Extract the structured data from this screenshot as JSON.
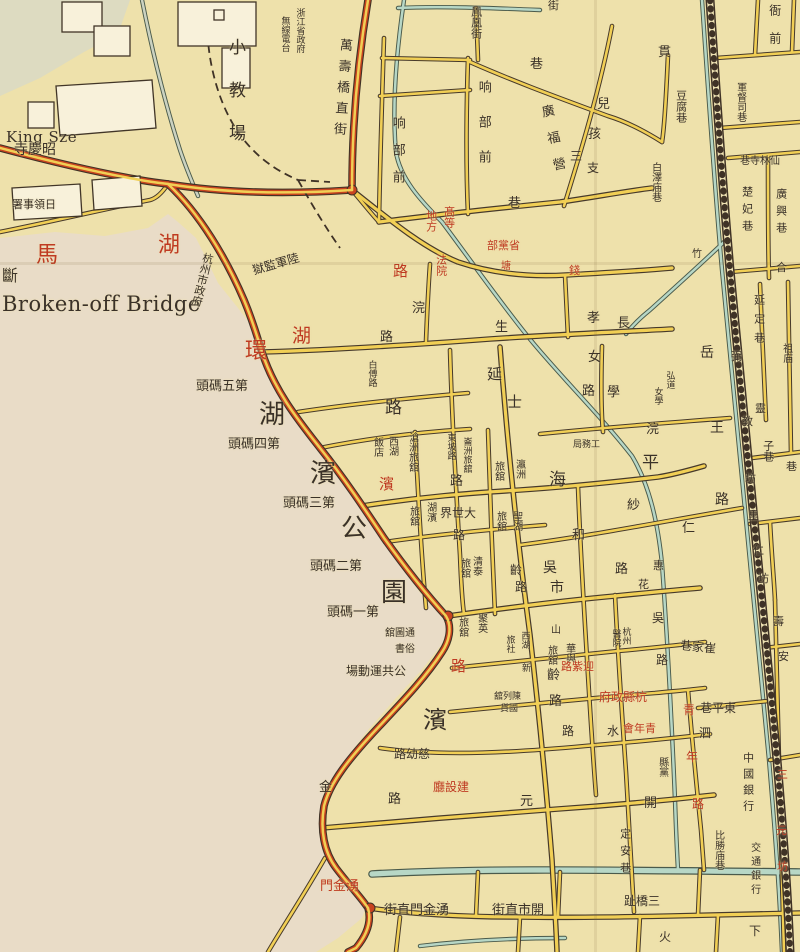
{
  "page_title": "Broken-off Bridge",
  "map": {
    "colors": {
      "paper": "#eee1ab",
      "lake": "#e9dcc7",
      "road": "#f1cf55",
      "road_red": "#c8431f",
      "stream": "#b7d7c6",
      "ink": "#3a3128",
      "red_text": "#bf3a22"
    },
    "dots": [
      {
        "x": 352,
        "y": 190
      },
      {
        "x": 448,
        "y": 616
      },
      {
        "x": 370,
        "y": 908
      }
    ],
    "labels": [
      {
        "t": "King Sze",
        "x": 6,
        "y": 130,
        "s": 15,
        "d": "h",
        "c": "ink",
        "en": 1
      },
      {
        "t": "寺慶昭",
        "x": 14,
        "y": 143,
        "s": 14,
        "d": "h"
      },
      {
        "t": "署事領日",
        "x": 12,
        "y": 199,
        "s": 11,
        "d": "h"
      },
      {
        "t": "斷",
        "x": 2,
        "y": 268,
        "s": 16,
        "d": "h"
      },
      {
        "t": "Broken-off Bridge",
        "x": 2,
        "y": 293,
        "s": 21,
        "d": "h",
        "c": "ink",
        "en": 1
      },
      {
        "t": "馬",
        "x": 36,
        "y": 244,
        "s": 22,
        "d": "h",
        "c": "red"
      },
      {
        "t": "湖",
        "x": 158,
        "y": 234,
        "s": 22,
        "d": "h",
        "c": "red"
      },
      {
        "t": "杭州市政府",
        "x": 196,
        "y": 252,
        "s": 11,
        "d": "v",
        "r": 14
      },
      {
        "t": "環",
        "x": 245,
        "y": 340,
        "s": 22,
        "d": "h",
        "c": "red"
      },
      {
        "t": "湖",
        "x": 292,
        "y": 326,
        "s": 19,
        "d": "h",
        "c": "red"
      },
      {
        "t": "路",
        "x": 393,
        "y": 264,
        "s": 15,
        "d": "h",
        "c": "red"
      },
      {
        "t": "獄監軍陸",
        "x": 252,
        "y": 258,
        "s": 12,
        "d": "h",
        "r": -16
      },
      {
        "t": "小教場",
        "x": 226,
        "y": 38,
        "s": 17,
        "d": "v",
        "lh": 26
      },
      {
        "t": "浙江省政府",
        "x": 294,
        "y": 8,
        "s": 9,
        "d": "v"
      },
      {
        "t": "無線電台",
        "x": 279,
        "y": 16,
        "s": 9,
        "d": "v"
      },
      {
        "t": "萬壽橋直街",
        "x": 334,
        "y": 38,
        "s": 13,
        "d": "v",
        "r": 4,
        "lh": 8
      },
      {
        "t": "响部前",
        "x": 390,
        "y": 116,
        "s": 13,
        "d": "v",
        "lh": 14
      },
      {
        "t": "响部前",
        "x": 476,
        "y": 80,
        "s": 13,
        "d": "v",
        "lh": 22
      },
      {
        "t": "巷",
        "x": 508,
        "y": 197,
        "s": 13,
        "d": "h"
      },
      {
        "t": "鳳凰街",
        "x": 470,
        "y": 6,
        "s": 11,
        "d": "v"
      },
      {
        "t": "街",
        "x": 548,
        "y": 0,
        "s": 11,
        "d": "h"
      },
      {
        "t": "巷",
        "x": 530,
        "y": 58,
        "s": 13,
        "d": "h"
      },
      {
        "t": "廣福營",
        "x": 546,
        "y": 104,
        "s": 13,
        "d": "v",
        "r": -12,
        "lh": 14
      },
      {
        "t": "孩",
        "x": 588,
        "y": 128,
        "s": 13,
        "d": "h"
      },
      {
        "t": "兒",
        "x": 597,
        "y": 98,
        "s": 13,
        "d": "h"
      },
      {
        "t": "三",
        "x": 570,
        "y": 150,
        "s": 12,
        "d": "h"
      },
      {
        "t": "支",
        "x": 587,
        "y": 162,
        "s": 12,
        "d": "h"
      },
      {
        "t": "竹",
        "x": 692,
        "y": 250,
        "s": 10,
        "d": "h"
      },
      {
        "t": "貫",
        "x": 658,
        "y": 46,
        "s": 13,
        "d": "h"
      },
      {
        "t": "豆腐巷",
        "x": 675,
        "y": 90,
        "s": 11,
        "d": "v"
      },
      {
        "t": "軍督司巷",
        "x": 734,
        "y": 82,
        "s": 10,
        "d": "v"
      },
      {
        "t": "巷寺林仙",
        "x": 740,
        "y": 157,
        "s": 10,
        "d": "h"
      },
      {
        "t": "楚妃巷",
        "x": 741,
        "y": 186,
        "s": 11,
        "d": "v",
        "lh": 6
      },
      {
        "t": "廣興巷",
        "x": 775,
        "y": 188,
        "s": 11,
        "d": "v",
        "lh": 6
      },
      {
        "t": "合",
        "x": 776,
        "y": 262,
        "s": 11,
        "d": "h"
      },
      {
        "t": "白澤庙巷",
        "x": 649,
        "y": 162,
        "s": 10,
        "d": "v"
      },
      {
        "t": "衙前",
        "x": 768,
        "y": 4,
        "s": 12,
        "d": "v",
        "lh": 16
      },
      {
        "t": "地方",
        "x": 425,
        "y": 210,
        "s": 11,
        "d": "v",
        "c": "red"
      },
      {
        "t": "髙等",
        "x": 443,
        "y": 206,
        "s": 11,
        "d": "v",
        "c": "red"
      },
      {
        "t": "法院",
        "x": 435,
        "y": 254,
        "s": 11,
        "d": "v",
        "c": "red"
      },
      {
        "t": "部黨省",
        "x": 487,
        "y": 240,
        "s": 11,
        "d": "h",
        "c": "red"
      },
      {
        "t": "塘",
        "x": 501,
        "y": 262,
        "s": 10,
        "d": "h",
        "c": "red"
      },
      {
        "t": "錢",
        "x": 569,
        "y": 265,
        "s": 11,
        "d": "h",
        "c": "red"
      },
      {
        "t": "浣",
        "x": 412,
        "y": 302,
        "s": 13,
        "d": "h"
      },
      {
        "t": "生",
        "x": 495,
        "y": 321,
        "s": 13,
        "d": "h"
      },
      {
        "t": "路",
        "x": 380,
        "y": 331,
        "s": 13,
        "d": "h"
      },
      {
        "t": "長",
        "x": 617,
        "y": 317,
        "s": 13,
        "d": "h"
      },
      {
        "t": "孝",
        "x": 587,
        "y": 312,
        "s": 13,
        "d": "h"
      },
      {
        "t": "女",
        "x": 588,
        "y": 351,
        "s": 13,
        "d": "h"
      },
      {
        "t": "路",
        "x": 582,
        "y": 385,
        "s": 13,
        "d": "h"
      },
      {
        "t": "學",
        "x": 607,
        "y": 386,
        "s": 13,
        "d": "h"
      },
      {
        "t": "弘道",
        "x": 664,
        "y": 371,
        "s": 9,
        "d": "v"
      },
      {
        "t": "女學",
        "x": 652,
        "y": 387,
        "s": 9,
        "d": "v"
      },
      {
        "t": "岳",
        "x": 700,
        "y": 346,
        "s": 14,
        "d": "h"
      },
      {
        "t": "王",
        "x": 710,
        "y": 421,
        "s": 14,
        "d": "h"
      },
      {
        "t": "路",
        "x": 715,
        "y": 493,
        "s": 14,
        "d": "h"
      },
      {
        "t": "白傅路",
        "x": 366,
        "y": 360,
        "s": 9,
        "d": "v"
      },
      {
        "t": "路",
        "x": 385,
        "y": 399,
        "s": 17,
        "d": "h"
      },
      {
        "t": "西湖",
        "x": 386,
        "y": 436,
        "s": 10,
        "d": "v"
      },
      {
        "t": "飯店",
        "x": 371,
        "y": 437,
        "s": 10,
        "d": "v"
      },
      {
        "t": "滄洲旅舘",
        "x": 406,
        "y": 432,
        "s": 10,
        "d": "v"
      },
      {
        "t": "東坡路",
        "x": 445,
        "y": 433,
        "s": 9,
        "d": "v"
      },
      {
        "t": "崙洲旅舘",
        "x": 461,
        "y": 437,
        "s": 9,
        "d": "v"
      },
      {
        "t": "路",
        "x": 450,
        "y": 475,
        "s": 13,
        "d": "h"
      },
      {
        "t": "瀛洲",
        "x": 513,
        "y": 459,
        "s": 10,
        "d": "v"
      },
      {
        "t": "旅舘",
        "x": 492,
        "y": 461,
        "s": 10,
        "d": "v"
      },
      {
        "t": "海",
        "x": 549,
        "y": 471,
        "s": 17,
        "d": "h"
      },
      {
        "t": "平",
        "x": 642,
        "y": 454,
        "s": 17,
        "d": "h"
      },
      {
        "t": "延",
        "x": 487,
        "y": 367,
        "s": 15,
        "d": "h"
      },
      {
        "t": "士",
        "x": 507,
        "y": 395,
        "s": 15,
        "d": "h"
      },
      {
        "t": "湖濱",
        "x": 424,
        "y": 502,
        "s": 10,
        "d": "v"
      },
      {
        "t": "旅舘",
        "x": 407,
        "y": 506,
        "s": 10,
        "d": "v"
      },
      {
        "t": "界世大",
        "x": 440,
        "y": 507,
        "s": 12,
        "d": "h"
      },
      {
        "t": "路",
        "x": 453,
        "y": 529,
        "s": 12,
        "d": "h"
      },
      {
        "t": "聖湖",
        "x": 510,
        "y": 511,
        "s": 10,
        "d": "v"
      },
      {
        "t": "旅舘",
        "x": 494,
        "y": 511,
        "s": 10,
        "d": "v"
      },
      {
        "t": "和",
        "x": 572,
        "y": 529,
        "s": 13,
        "d": "h"
      },
      {
        "t": "仁",
        "x": 682,
        "y": 522,
        "s": 13,
        "d": "h"
      },
      {
        "t": "浣",
        "x": 646,
        "y": 423,
        "s": 13,
        "d": "h"
      },
      {
        "t": "紗",
        "x": 627,
        "y": 499,
        "s": 13,
        "d": "h"
      },
      {
        "t": "路",
        "x": 615,
        "y": 563,
        "s": 13,
        "d": "h"
      },
      {
        "t": "惠",
        "x": 653,
        "y": 560,
        "s": 11,
        "d": "h"
      },
      {
        "t": "花",
        "x": 638,
        "y": 579,
        "s": 11,
        "d": "h"
      },
      {
        "t": "吳",
        "x": 543,
        "y": 561,
        "s": 14,
        "d": "h"
      },
      {
        "t": "市",
        "x": 550,
        "y": 581,
        "s": 14,
        "d": "h"
      },
      {
        "t": "齡",
        "x": 510,
        "y": 564,
        "s": 12,
        "d": "h"
      },
      {
        "t": "路",
        "x": 515,
        "y": 581,
        "s": 12,
        "d": "h"
      },
      {
        "t": "清泰",
        "x": 470,
        "y": 556,
        "s": 10,
        "d": "v"
      },
      {
        "t": "旅舘",
        "x": 458,
        "y": 558,
        "s": 10,
        "d": "v"
      },
      {
        "t": "聚英",
        "x": 475,
        "y": 613,
        "s": 10,
        "d": "v"
      },
      {
        "t": "旅舘",
        "x": 456,
        "y": 617,
        "s": 10,
        "d": "v"
      },
      {
        "t": "西湖",
        "x": 519,
        "y": 631,
        "s": 9,
        "d": "v"
      },
      {
        "t": "新",
        "x": 522,
        "y": 665,
        "s": 9,
        "d": "h"
      },
      {
        "t": "旅社",
        "x": 504,
        "y": 635,
        "s": 9,
        "d": "v"
      },
      {
        "t": "山",
        "x": 551,
        "y": 626,
        "s": 10,
        "d": "h"
      },
      {
        "t": "旅舘",
        "x": 545,
        "y": 645,
        "s": 10,
        "d": "v"
      },
      {
        "t": "華與",
        "x": 563,
        "y": 643,
        "s": 10,
        "d": "v"
      },
      {
        "t": "齡",
        "x": 547,
        "y": 669,
        "s": 13,
        "d": "h"
      },
      {
        "t": "路",
        "x": 549,
        "y": 695,
        "s": 13,
        "d": "h"
      },
      {
        "t": "路",
        "x": 562,
        "y": 725,
        "s": 12,
        "d": "h"
      },
      {
        "t": "杭州",
        "x": 620,
        "y": 627,
        "s": 9,
        "d": "v"
      },
      {
        "t": "醫院",
        "x": 610,
        "y": 629,
        "s": 9,
        "d": "v"
      },
      {
        "t": "吳",
        "x": 652,
        "y": 612,
        "s": 12,
        "d": "h"
      },
      {
        "t": "路",
        "x": 656,
        "y": 654,
        "s": 12,
        "d": "h"
      },
      {
        "t": "巷家崔",
        "x": 680,
        "y": 641,
        "s": 12,
        "d": "h",
        "r": 6
      },
      {
        "t": "路紫迎",
        "x": 561,
        "y": 661,
        "s": 11,
        "d": "h",
        "c": "red"
      },
      {
        "t": "府政縣杭",
        "x": 599,
        "y": 691,
        "s": 12,
        "d": "h",
        "c": "red"
      },
      {
        "t": "會年青",
        "x": 623,
        "y": 723,
        "s": 11,
        "d": "h",
        "c": "red"
      },
      {
        "t": "水",
        "x": 607,
        "y": 725,
        "s": 12,
        "d": "h"
      },
      {
        "t": "青",
        "x": 683,
        "y": 704,
        "s": 12,
        "d": "h",
        "c": "red"
      },
      {
        "t": "年",
        "x": 686,
        "y": 751,
        "s": 12,
        "d": "h",
        "c": "red"
      },
      {
        "t": "路",
        "x": 692,
        "y": 798,
        "s": 12,
        "d": "h",
        "c": "red"
      },
      {
        "t": "縣黨",
        "x": 656,
        "y": 757,
        "s": 10,
        "d": "v"
      },
      {
        "t": "泗",
        "x": 699,
        "y": 727,
        "s": 12,
        "d": "h"
      },
      {
        "t": "巷平東",
        "x": 700,
        "y": 702,
        "s": 12,
        "d": "h"
      },
      {
        "t": "中國銀行",
        "x": 742,
        "y": 752,
        "s": 11,
        "d": "v",
        "lh": 5
      },
      {
        "t": "開",
        "x": 644,
        "y": 797,
        "s": 13,
        "d": "h"
      },
      {
        "t": "元",
        "x": 520,
        "y": 795,
        "s": 13,
        "d": "h"
      },
      {
        "t": "廳設建",
        "x": 433,
        "y": 781,
        "s": 12,
        "d": "h",
        "c": "red"
      },
      {
        "t": "路幼慈",
        "x": 394,
        "y": 748,
        "s": 12,
        "d": "h"
      },
      {
        "t": "舘列陳",
        "x": 494,
        "y": 693,
        "s": 9,
        "d": "h"
      },
      {
        "t": "貨國",
        "x": 500,
        "y": 705,
        "s": 9,
        "d": "h"
      },
      {
        "t": "濱",
        "x": 423,
        "y": 708,
        "s": 24,
        "d": "h"
      },
      {
        "t": "湖",
        "x": 259,
        "y": 402,
        "s": 26,
        "d": "h"
      },
      {
        "t": "濱",
        "x": 310,
        "y": 461,
        "s": 26,
        "d": "h"
      },
      {
        "t": "公",
        "x": 341,
        "y": 516,
        "s": 26,
        "d": "h"
      },
      {
        "t": "園",
        "x": 381,
        "y": 580,
        "s": 26,
        "d": "h"
      },
      {
        "t": "頭碼五第",
        "x": 196,
        "y": 380,
        "s": 13,
        "d": "h"
      },
      {
        "t": "頭碼四第",
        "x": 228,
        "y": 438,
        "s": 13,
        "d": "h"
      },
      {
        "t": "頭碼三第",
        "x": 283,
        "y": 497,
        "s": 13,
        "d": "h"
      },
      {
        "t": "頭碼二第",
        "x": 310,
        "y": 560,
        "s": 13,
        "d": "h"
      },
      {
        "t": "頭碼一第",
        "x": 327,
        "y": 606,
        "s": 13,
        "d": "h"
      },
      {
        "t": "濱",
        "x": 379,
        "y": 477,
        "s": 15,
        "d": "h",
        "c": "red"
      },
      {
        "t": "路",
        "x": 451,
        "y": 659,
        "s": 15,
        "d": "h",
        "c": "red"
      },
      {
        "t": "舘圖通",
        "x": 385,
        "y": 629,
        "s": 10,
        "d": "h"
      },
      {
        "t": "書俗",
        "x": 395,
        "y": 645,
        "s": 10,
        "d": "h"
      },
      {
        "t": "場動運共公",
        "x": 346,
        "y": 665,
        "s": 12,
        "d": "h"
      },
      {
        "t": "金",
        "x": 319,
        "y": 781,
        "s": 13,
        "d": "h"
      },
      {
        "t": "路",
        "x": 388,
        "y": 793,
        "s": 13,
        "d": "h"
      },
      {
        "t": "門金湧",
        "x": 320,
        "y": 880,
        "s": 13,
        "d": "h",
        "c": "red"
      },
      {
        "t": "街直門金湧",
        "x": 384,
        "y": 904,
        "s": 13,
        "d": "h"
      },
      {
        "t": "街直市開",
        "x": 492,
        "y": 904,
        "s": 13,
        "d": "h"
      },
      {
        "t": "定安巷",
        "x": 619,
        "y": 828,
        "s": 11,
        "d": "v",
        "lh": 6
      },
      {
        "t": "趾橋三",
        "x": 624,
        "y": 895,
        "s": 12,
        "d": "h"
      },
      {
        "t": "比勝庙巷",
        "x": 712,
        "y": 830,
        "s": 10,
        "d": "v"
      },
      {
        "t": "交通銀行",
        "x": 748,
        "y": 842,
        "s": 10,
        "d": "v",
        "lh": 4
      },
      {
        "t": "三",
        "x": 777,
        "y": 769,
        "s": 11,
        "d": "h",
        "c": "red"
      },
      {
        "t": "元",
        "x": 776,
        "y": 825,
        "s": 11,
        "d": "h",
        "c": "red"
      },
      {
        "t": "坊",
        "x": 777,
        "y": 861,
        "s": 11,
        "d": "h",
        "c": "red"
      },
      {
        "t": "下",
        "x": 749,
        "y": 925,
        "s": 12,
        "d": "h"
      },
      {
        "t": "火",
        "x": 659,
        "y": 931,
        "s": 12,
        "d": "h"
      },
      {
        "t": "延定巷",
        "x": 753,
        "y": 294,
        "s": 11,
        "d": "v",
        "lh": 8
      },
      {
        "t": "祖庙",
        "x": 780,
        "y": 343,
        "s": 10,
        "d": "v"
      },
      {
        "t": "靈",
        "x": 755,
        "y": 403,
        "s": 11,
        "d": "h"
      },
      {
        "t": "子巷",
        "x": 762,
        "y": 440,
        "s": 11,
        "d": "v"
      },
      {
        "t": "巷",
        "x": 786,
        "y": 461,
        "s": 11,
        "d": "h"
      },
      {
        "t": "弼",
        "x": 731,
        "y": 351,
        "s": 11,
        "d": "h"
      },
      {
        "t": "教",
        "x": 742,
        "y": 416,
        "s": 11,
        "d": "h"
      },
      {
        "t": "坊",
        "x": 745,
        "y": 473,
        "s": 11,
        "d": "h"
      },
      {
        "t": "里",
        "x": 748,
        "y": 510,
        "s": 11,
        "d": "h"
      },
      {
        "t": "仁",
        "x": 753,
        "y": 545,
        "s": 11,
        "d": "h"
      },
      {
        "t": "坊",
        "x": 758,
        "y": 573,
        "s": 11,
        "d": "h"
      },
      {
        "t": "壽",
        "x": 773,
        "y": 616,
        "s": 11,
        "d": "h"
      },
      {
        "t": "安",
        "x": 778,
        "y": 651,
        "s": 11,
        "d": "h"
      },
      {
        "t": "局務工",
        "x": 573,
        "y": 441,
        "s": 9,
        "d": "h"
      }
    ]
  }
}
